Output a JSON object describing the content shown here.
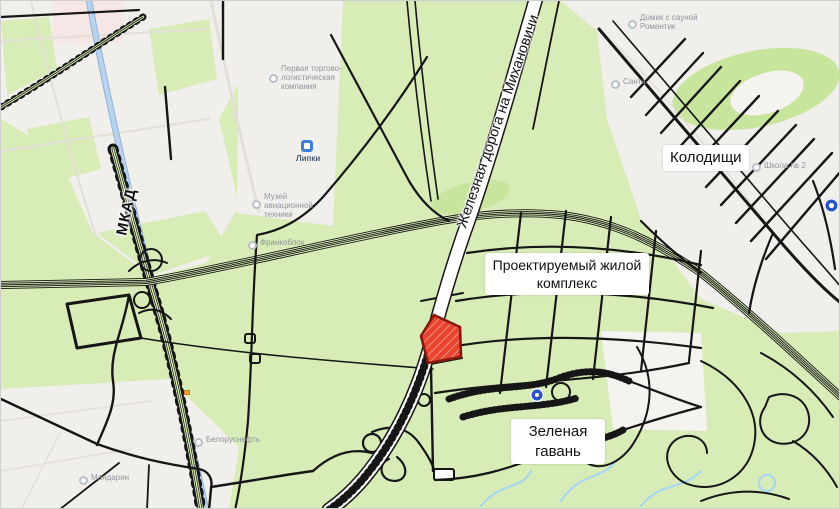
{
  "colors": {
    "map_green": "#d7ecb6",
    "map_green_dark": "#c8e59e",
    "urban": "#f1efeb",
    "urban_soft": "#f5f3f0",
    "pink_zone": "#f6e7e6",
    "road_black": "#161616",
    "rail_white": "#ffffff",
    "highway_blue": "#b9d3ee",
    "highway_blue_edge": "#8fb2d9",
    "water_blue": "#a5d5f2",
    "parcel_red": "#e84531",
    "parcel_red_dark": "#8a170c",
    "parcel_hatch": "#f49c8e",
    "poi_grey": "#8f959d",
    "poi_icon_grey": "#b9bfc7",
    "marker_blue": "#2a54c6",
    "badge_blue": "#3f7ed6",
    "label_text": "#111111",
    "orange_marker": "#f2a43c"
  },
  "map": {
    "schematic_labels": {
      "mkad": "МКАД",
      "railway": "Железная дорога на Михановичи",
      "kolodishchi": "Колодищи",
      "planned_complex": "Проектируемый жилой комплекс",
      "green_harbor": "Зеленая гавань"
    },
    "base_pois": [
      {
        "label": "Первая торгово-логистическая компания"
      },
      {
        "label": "Липки"
      },
      {
        "label": "Музей авиационной техники"
      },
      {
        "label": "Франкоблок"
      },
      {
        "label": "Мандарин"
      },
      {
        "label": "Белоруснефть"
      },
      {
        "label": "Санта"
      },
      {
        "label": "Домик с сауной Романтик"
      },
      {
        "label": "Школа № 2"
      }
    ]
  }
}
